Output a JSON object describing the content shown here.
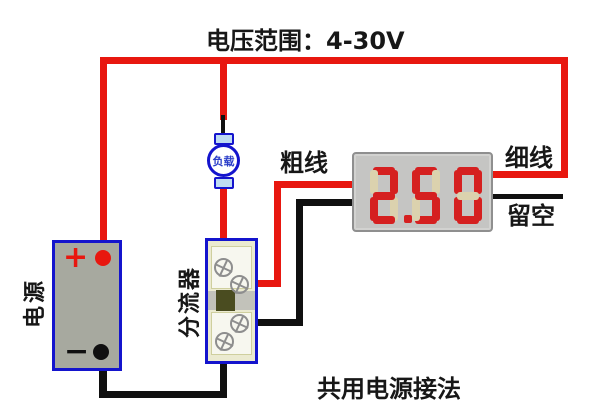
{
  "title": "电压范围：4-30V",
  "labels": {
    "thick_wire": "粗线",
    "thin_wire": "细线",
    "leave_empty": "留空",
    "bottom_caption": "共用电源接法"
  },
  "components": {
    "power_supply": {
      "label": "电源",
      "plus": "+",
      "minus": "−"
    },
    "load": {
      "label": "负载"
    },
    "shunt": {
      "label": "分流器"
    },
    "voltmeter": {
      "display_value": "2.50"
    }
  },
  "colors": {
    "wire_red": "#e8170f",
    "wire_black": "#101010",
    "component_blue": "#1414cd",
    "battery_fill": "#a7a99f",
    "shunt_fill": "#ebead0",
    "meter_bezel": "#c5c5c3",
    "segment_lit": "#d52020",
    "segment_unlit": "#dbd2ae",
    "load_terminal_fill": "#bedbf2"
  }
}
